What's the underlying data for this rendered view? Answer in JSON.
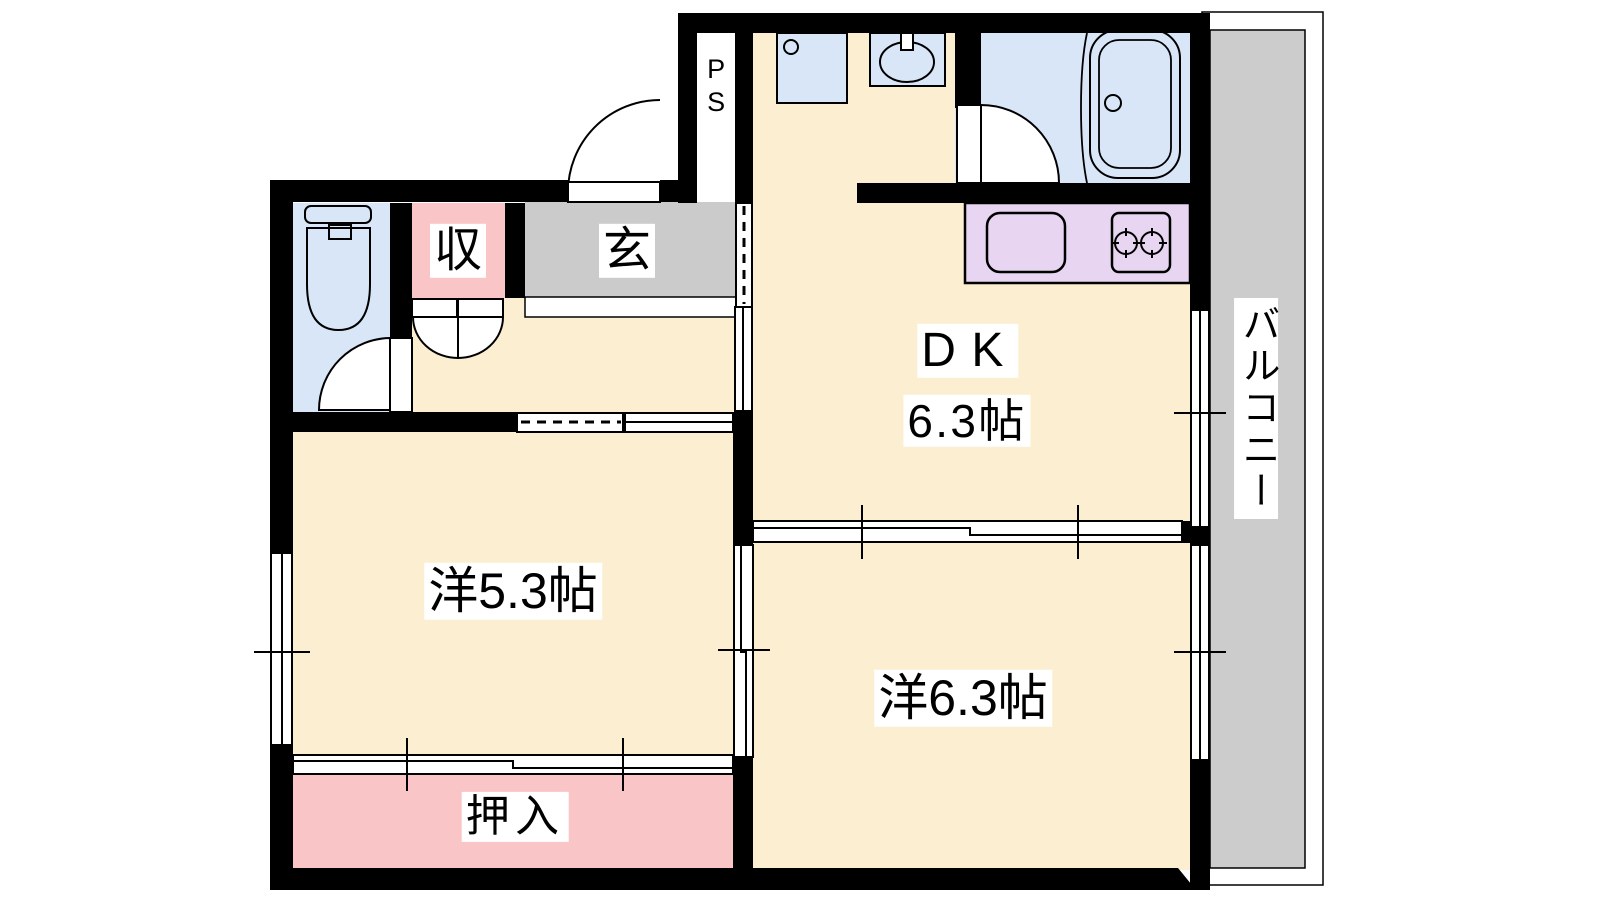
{
  "plan_title": "2DK apartment floor plan",
  "rooms": {
    "dk": {
      "name": "DK",
      "size": "6.3帖"
    },
    "western_room_1": {
      "label": "洋5.3帖"
    },
    "western_room_2": {
      "label": "洋6.3帖"
    },
    "oshiire_closet": {
      "label": "押入"
    },
    "storage": {
      "label": "収"
    },
    "entrance": {
      "label": "玄"
    },
    "pipe_space": {
      "label": "PS"
    },
    "balcony": {
      "label": "バルコニー"
    }
  },
  "fixtures": [
    "toilet-icon",
    "washer-pan-icon",
    "wash-basin-icon",
    "bathtub-icon",
    "kitchen-sink-icon",
    "two-burner-stove-icon"
  ],
  "colors": {
    "wall": "#000000",
    "room_cream": "#FCEFD1",
    "closet_pink": "#F9C5C7",
    "wet_area_blue": "#D8E6F8",
    "kitchen_purple": "#E7D5F1",
    "entrance_gray": "#CBCBCB",
    "balcony_gray": "#CCCCCC",
    "background": "#FFFFFF"
  }
}
